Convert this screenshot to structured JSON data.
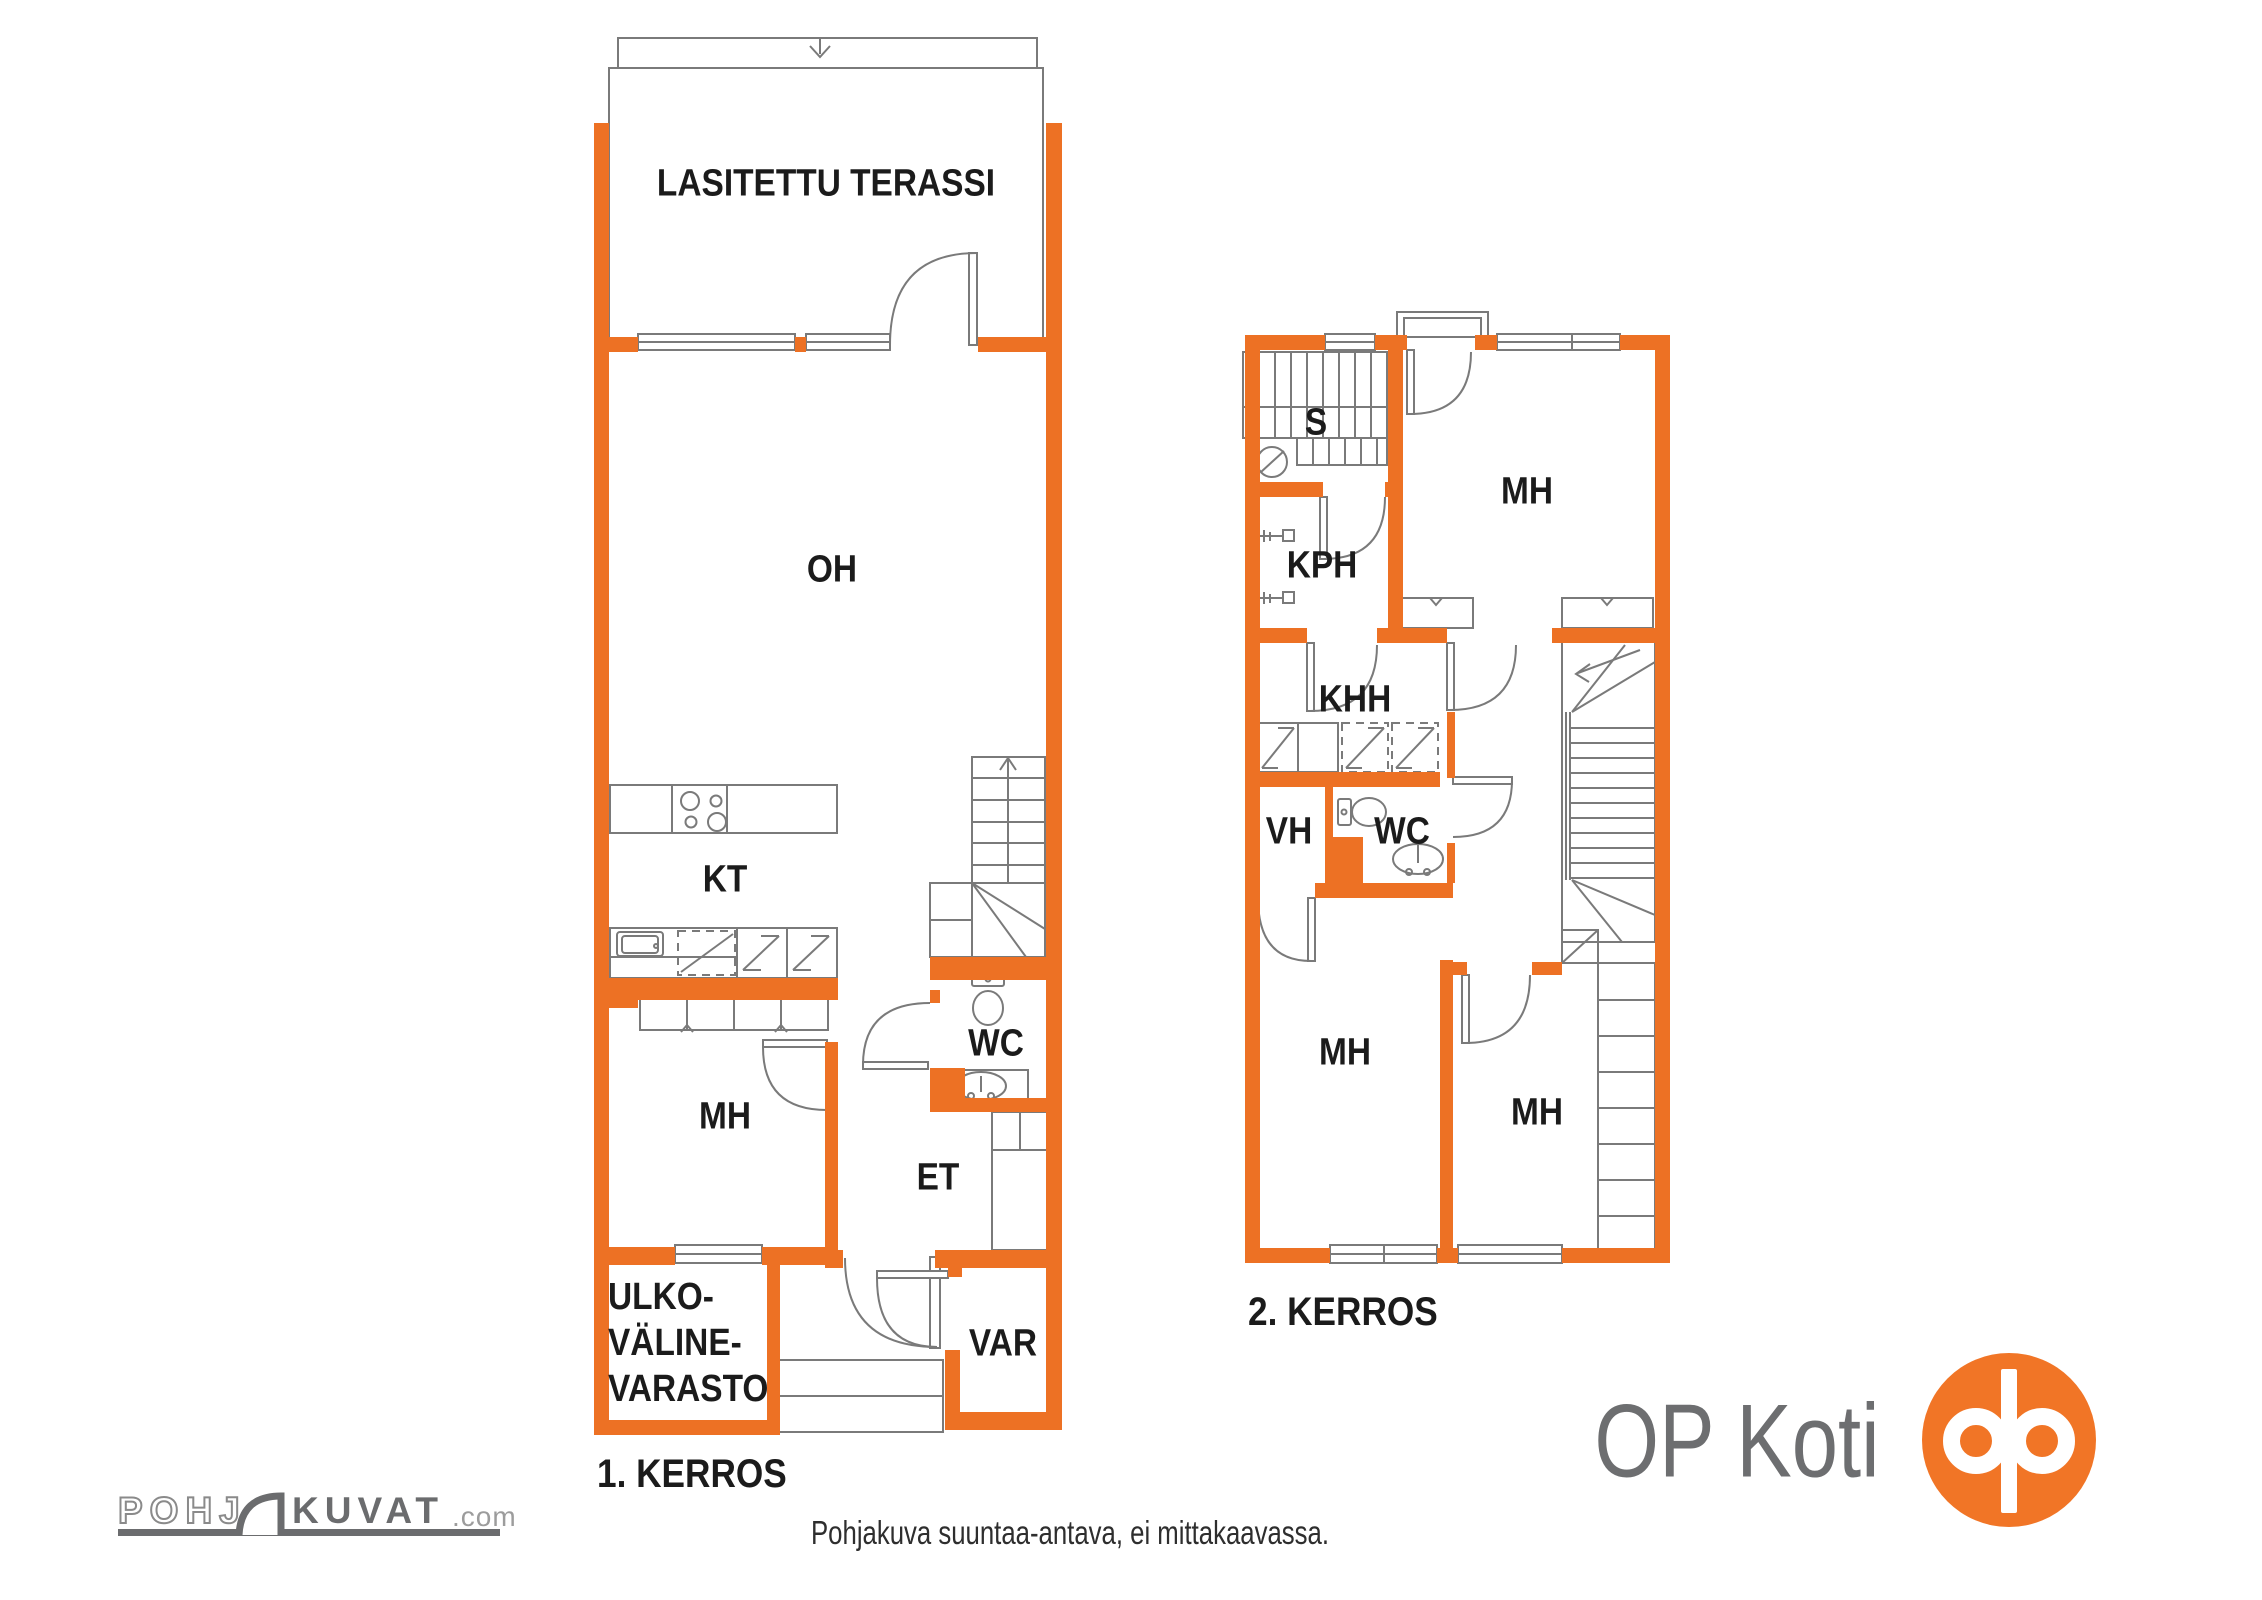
{
  "colors": {
    "wall_orange": "#ED7124",
    "op_orange": "#F17526",
    "line_gray": "#7A7A7A",
    "label_black": "#1B1B1B",
    "logo_gray": "#6B6C6E",
    "logo_light_gray": "#9C9C9C"
  },
  "floor1": {
    "title": "1. KERROS",
    "rooms": {
      "terrace": "LASITETTU TERASSI",
      "living": "OH",
      "kitchen": "KT",
      "bedroom": "MH",
      "wc": "WC",
      "hall": "ET",
      "storage": "VAR",
      "outdoor_storage_line1": "ULKO-",
      "outdoor_storage_line2": "VÄLINE-",
      "outdoor_storage_line3": "VARASTO"
    }
  },
  "floor2": {
    "title": "2. KERROS",
    "rooms": {
      "sauna": "S",
      "bedroom_top": "MH",
      "bathroom": "KPH",
      "utility": "KHH",
      "closet": "VH",
      "wc": "WC",
      "bedroom_left": "MH",
      "bedroom_right": "MH"
    }
  },
  "footer": {
    "disclaimer": "Pohjakuva suuntaa-antava, ei mittakaavassa.",
    "watermark": {
      "part1": "POHJ",
      "part2": "KUVAT",
      "part3": ".com"
    },
    "brand": "OP Koti"
  }
}
